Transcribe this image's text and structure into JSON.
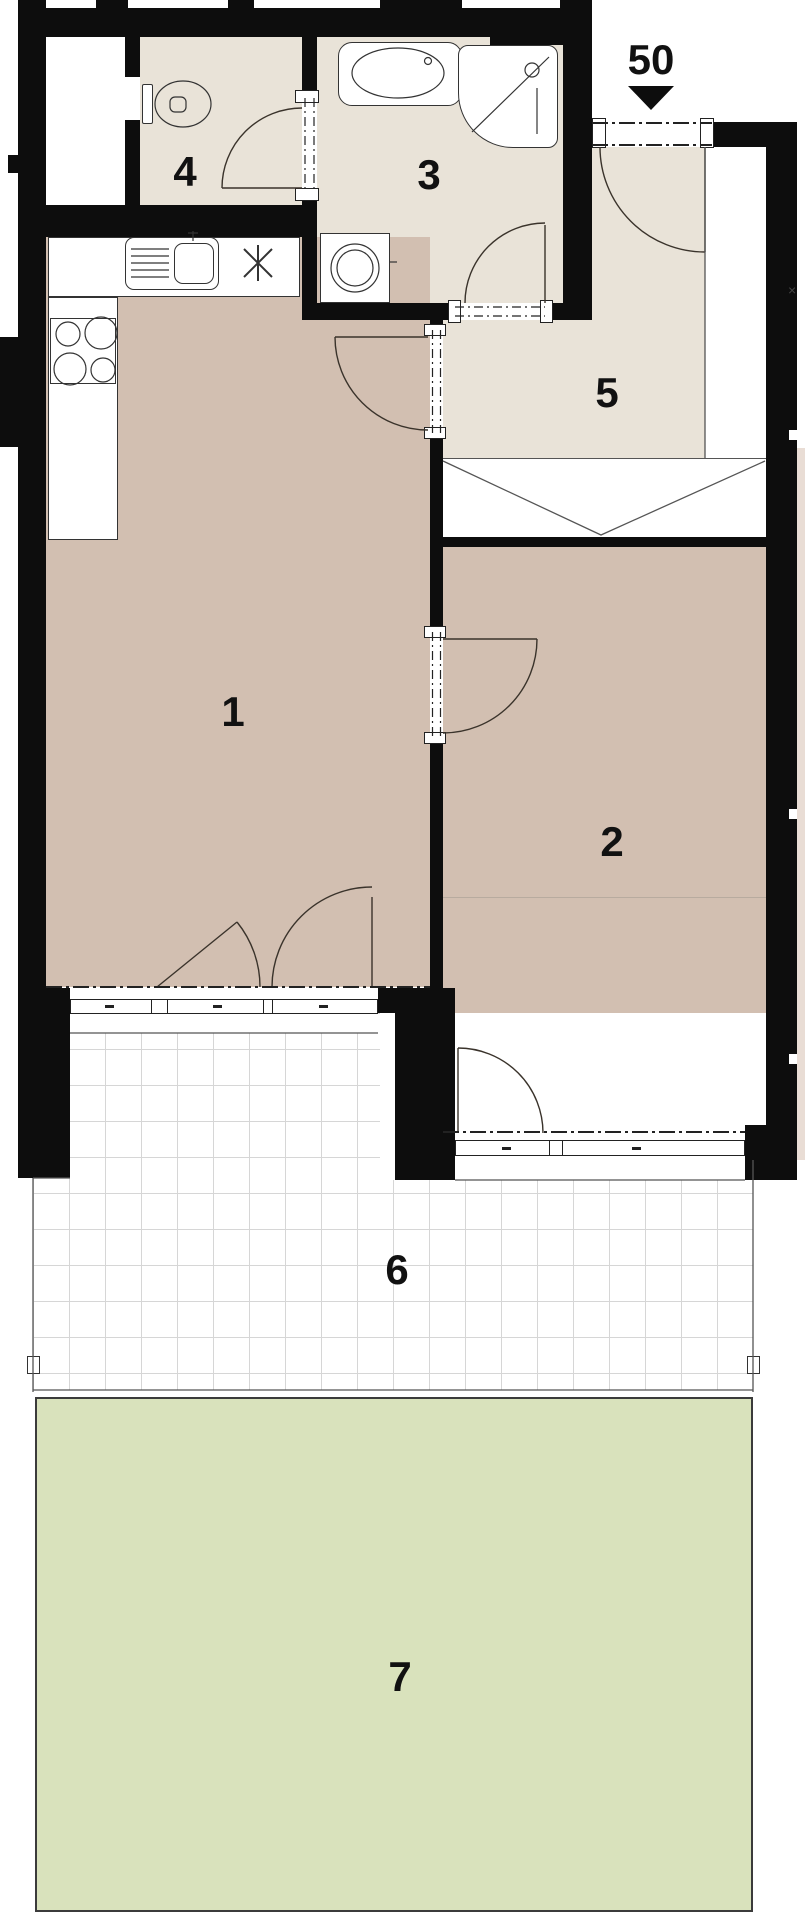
{
  "plan": {
    "entrance": {
      "label": "50"
    },
    "rooms": [
      {
        "id": 1,
        "label": "1"
      },
      {
        "id": 2,
        "label": "2"
      },
      {
        "id": 3,
        "label": "3"
      },
      {
        "id": 4,
        "label": "4"
      },
      {
        "id": 5,
        "label": "5"
      },
      {
        "id": 6,
        "label": "6"
      },
      {
        "id": 7,
        "label": "7"
      }
    ],
    "marks": {
      "dimension_cross": "×"
    },
    "colors": {
      "wall": "#0d0d0d",
      "floor_living": "#d2bfb1",
      "floor_bath": "#e9e3d8",
      "terrace_tile_line": "#d6d6d6",
      "garden": "#d9e2bc",
      "linework": "#3a332b"
    }
  }
}
